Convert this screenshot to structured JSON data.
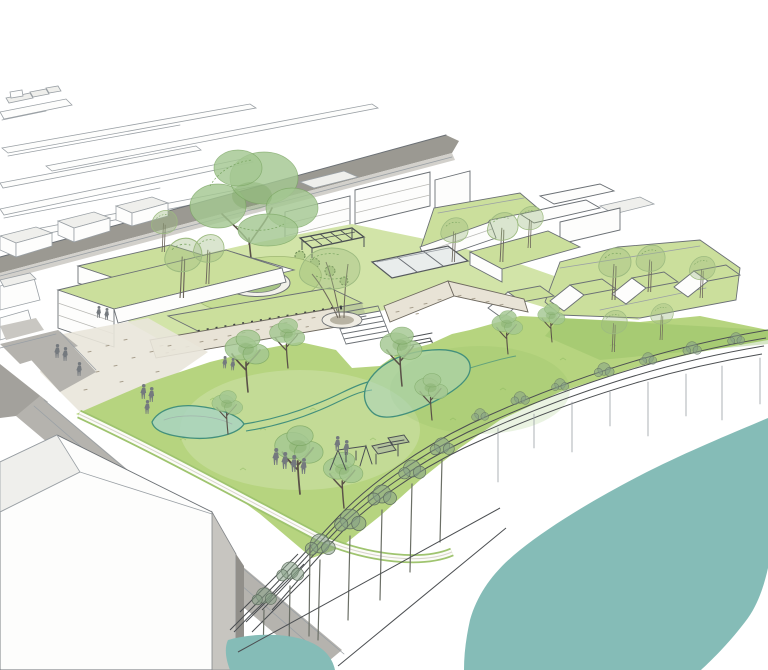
{
  "image": {
    "kind": "architectural-aerial-perspective-rendering",
    "subject": "riverside park and green-roof building development with railway, plaza, lawn, playground and river"
  },
  "colors": {
    "paper": "#ffffff",
    "line": "#6b7075",
    "line_soft": "#9aa0a5",
    "roof": "#cbdf9c",
    "podium": "#d2e4a8",
    "circle_lawn": "#c6dd94",
    "lawn": "#b6d47f",
    "lawn_deep": "#8cba5f",
    "canopy": "#a3c791",
    "canopy_line": "#76a35e",
    "airy": "#9dbb80",
    "bank_tree": "#87a086",
    "bank_line": "#5f6e5f",
    "river": "#85bcb7",
    "pond": "#a9d4bf",
    "swale": "#43907c",
    "road": "#9b9992",
    "road_light": "#b5b3ae",
    "sidewalk": "#d2d0cb",
    "facade": "#efefec",
    "facade_dark": "#c7c5c0",
    "stone": "#e8e3d6",
    "stone_line": "#6f6a60",
    "speck": "#a89f8e",
    "people": "#74797e",
    "sketch": "#4c5054",
    "pergola": "#4b4f53",
    "pool_water": "#e9edec"
  }
}
